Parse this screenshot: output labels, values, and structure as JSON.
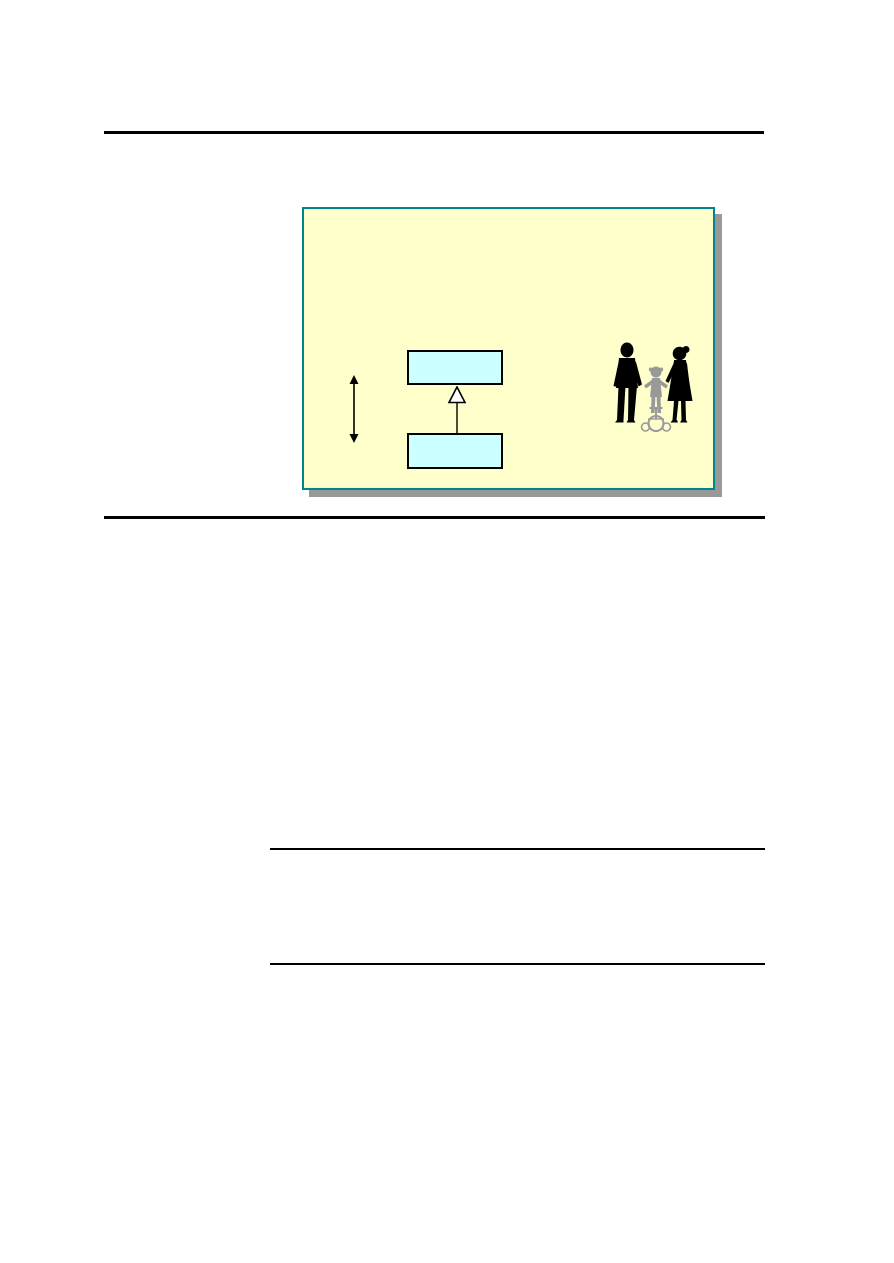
{
  "document": {
    "page_background": "#ffffff",
    "rule_color": "#000000"
  },
  "figure": {
    "background": "#ffffcc",
    "border": "#00858f",
    "shadow": "#999999",
    "class_box_fill": "#ccffff",
    "class_box_border": "#000000",
    "triangle_fill": "#ffffff",
    "line_color": "#000000",
    "adult_silhouette": "#000000",
    "child_silhouette": "#999999",
    "icons": {
      "double_arrow": "vertical-double-headed-arrow-icon",
      "generalization": "uml-generalization-triangle-icon",
      "clipart": "family-walking-silhouette"
    }
  }
}
